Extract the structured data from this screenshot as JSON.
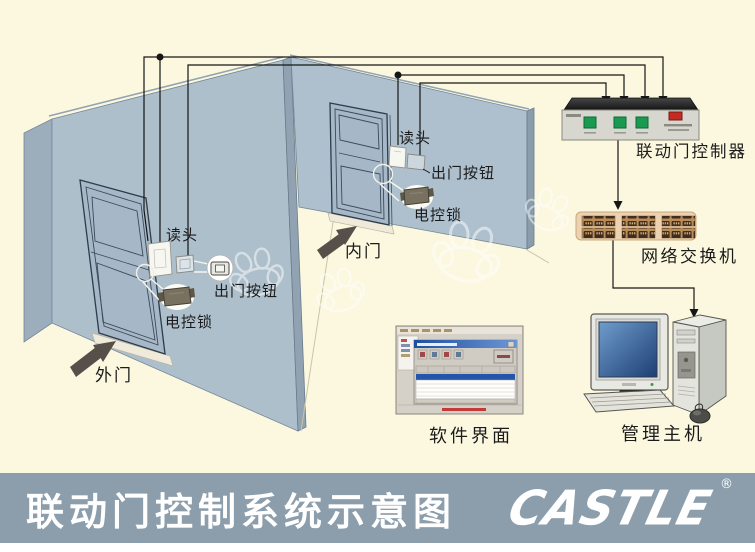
{
  "banner": {
    "title": "联动门控制系统示意图",
    "logo_text": "CASTLE",
    "registered_mark": "®"
  },
  "doors": {
    "outer_door_label": "外门",
    "inner_door_label": "内门"
  },
  "left_door_devices": {
    "reader_label": "读头",
    "exit_button_label": "出门按钮",
    "lock_label": "电控锁"
  },
  "right_door_devices": {
    "reader_label": "读头",
    "exit_button_label": "出门按钮",
    "lock_label": "电控锁"
  },
  "equipment": {
    "controller_label": "联动门控制器",
    "switch_label": "网络交换机",
    "software_label": "软件界面",
    "host_label": "管理主机"
  },
  "colors": {
    "background": "#FBF8DF",
    "wall": "#AEBFCC",
    "banner_bg": "#8C9EAB",
    "wire": "#161616",
    "controller_led_green": "#1A9A50",
    "controller_led_red": "#C22A22",
    "switch_body": "#ECD2B0",
    "screen_blue": "#2F5FA3"
  }
}
